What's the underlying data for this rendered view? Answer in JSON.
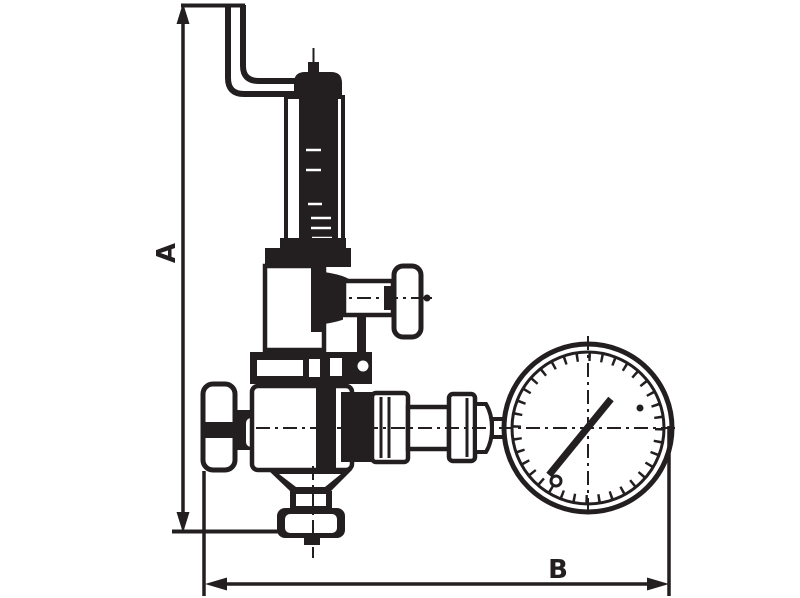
{
  "dimensions": {
    "vertical": {
      "label": "A"
    },
    "horizontal": {
      "label": "B"
    }
  },
  "colors": {
    "line": "#231f20",
    "background": "#ffffff"
  }
}
